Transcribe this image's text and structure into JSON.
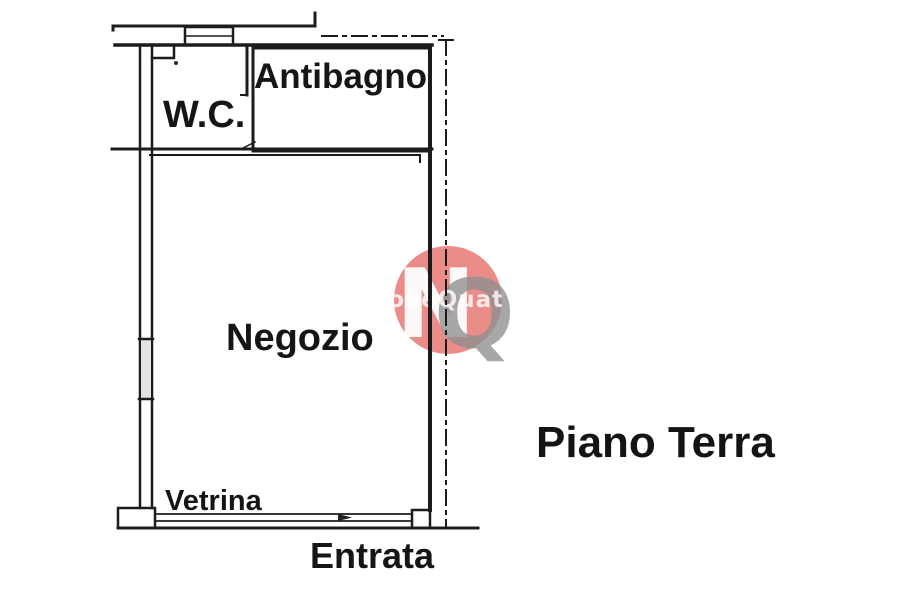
{
  "plan": {
    "rooms": [
      {
        "id": "wc",
        "label": "W.C."
      },
      {
        "id": "antibagno",
        "label": "Antibagno"
      },
      {
        "id": "negozio",
        "label": "Negozio"
      }
    ],
    "annotations": {
      "vetrina": "Vetrina",
      "entrata": "Entrata"
    },
    "floor_caption": "Piano Terra",
    "line_color": "#1c1c1c",
    "background_color": "#ffffff"
  },
  "watermark": {
    "monogram_n": "N",
    "monogram_q": "Q",
    "text": "NuoveQuattro",
    "circle_color": "#e8837f",
    "n_color": "#ffffff",
    "q_color": "#8f8f8f",
    "text_color": "#ffffff"
  }
}
